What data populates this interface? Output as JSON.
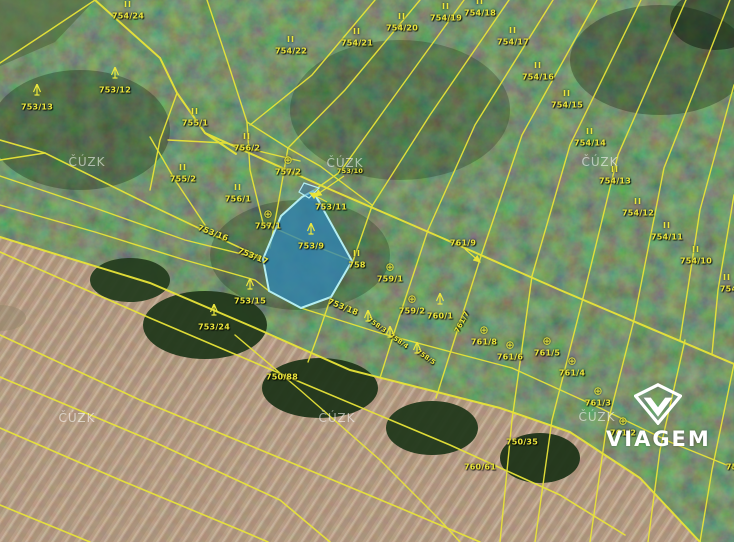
{
  "map": {
    "provider_watermark": "ČÚZK",
    "watermark_positions": [
      {
        "x": 87,
        "y": 162
      },
      {
        "x": 345,
        "y": 163
      },
      {
        "x": 600,
        "y": 162
      },
      {
        "x": 77,
        "y": 418
      },
      {
        "x": 337,
        "y": 418
      },
      {
        "x": 597,
        "y": 417
      }
    ],
    "highlight": {
      "parcel_number": "753/9",
      "fill": "#2f85b5",
      "border": "#b4eef2"
    },
    "colors": {
      "parcel_line": "#e8e438",
      "label": "#ece73d",
      "forest": "#2a4527",
      "field": "#b29478"
    },
    "labels": [
      {
        "text": "754/24",
        "x": 128,
        "y": 16,
        "sym": "forest"
      },
      {
        "text": "753/12",
        "x": 115,
        "y": 90,
        "sym": "conifer"
      },
      {
        "text": "753/13",
        "x": 37,
        "y": 107,
        "sym": "conifer"
      },
      {
        "text": "754/22",
        "x": 291,
        "y": 51,
        "sym": "forest"
      },
      {
        "text": "754/21",
        "x": 357,
        "y": 43,
        "sym": "forest"
      },
      {
        "text": "754/20",
        "x": 402,
        "y": 28,
        "sym": "forest"
      },
      {
        "text": "754/19",
        "x": 446,
        "y": 18,
        "sym": "forest"
      },
      {
        "text": "754/18",
        "x": 480,
        "y": 13,
        "sym": "forest"
      },
      {
        "text": "754/17",
        "x": 513,
        "y": 42,
        "sym": "forest"
      },
      {
        "text": "754/16",
        "x": 538,
        "y": 77,
        "sym": "forest"
      },
      {
        "text": "754/15",
        "x": 567,
        "y": 105,
        "sym": "forest"
      },
      {
        "text": "754/14",
        "x": 590,
        "y": 143,
        "sym": "forest"
      },
      {
        "text": "754/13",
        "x": 615,
        "y": 181,
        "sym": "forest"
      },
      {
        "text": "754/12",
        "x": 638,
        "y": 213,
        "sym": "forest"
      },
      {
        "text": "754/11",
        "x": 667,
        "y": 237,
        "sym": "forest"
      },
      {
        "text": "754/10",
        "x": 696,
        "y": 261,
        "sym": "forest"
      },
      {
        "text": "754/9",
        "x": 733,
        "y": 289,
        "sym": "forest",
        "symdx": -6
      },
      {
        "text": "755/1",
        "x": 195,
        "y": 123,
        "sym": "forest"
      },
      {
        "text": "756/2",
        "x": 247,
        "y": 148,
        "sym": "forest"
      },
      {
        "text": "755/2",
        "x": 183,
        "y": 179,
        "sym": "forest"
      },
      {
        "text": "756/1",
        "x": 238,
        "y": 199,
        "sym": "forest"
      },
      {
        "text": "757/2",
        "x": 288,
        "y": 172,
        "sym": "orchard"
      },
      {
        "text": "757/1",
        "x": 268,
        "y": 226,
        "sym": "orchard"
      },
      {
        "text": "753/10",
        "x": 350,
        "y": 171,
        "size": 6.5
      },
      {
        "text": "753/11",
        "x": 331,
        "y": 207
      },
      {
        "text": "753/9",
        "x": 311,
        "y": 246,
        "sym": "conifer"
      },
      {
        "text": "758",
        "x": 357,
        "y": 265,
        "sym": "forest"
      },
      {
        "text": "753/16",
        "x": 213,
        "y": 233,
        "rot": 21
      },
      {
        "text": "753/17",
        "x": 253,
        "y": 256,
        "rot": 22
      },
      {
        "text": "753/18",
        "x": 343,
        "y": 307,
        "rot": 22
      },
      {
        "text": "753/15",
        "x": 250,
        "y": 301,
        "sym": "conifer"
      },
      {
        "text": "753/24",
        "x": 214,
        "y": 327,
        "sym": "conifer"
      },
      {
        "text": "759/1",
        "x": 390,
        "y": 279,
        "sym": "orchard"
      },
      {
        "text": "759/2",
        "x": 412,
        "y": 311,
        "sym": "orchard"
      },
      {
        "text": "760/1",
        "x": 440,
        "y": 316,
        "sym": "conifer"
      },
      {
        "text": "761/9",
        "x": 463,
        "y": 243
      },
      {
        "text": "758/3",
        "x": 377,
        "y": 325,
        "rot": 35,
        "size": 6.5,
        "sym": "conifer",
        "symdx": -9,
        "symdy": -7
      },
      {
        "text": "758/4",
        "x": 399,
        "y": 341,
        "rot": 35,
        "size": 6.5,
        "sym": "conifer",
        "symdx": -9,
        "symdy": -7
      },
      {
        "text": "758/5",
        "x": 426,
        "y": 357,
        "rot": 35,
        "size": 6.5,
        "sym": "conifer",
        "symdx": -9,
        "symdy": -7
      },
      {
        "text": "761/7",
        "x": 462,
        "y": 322,
        "rot": -62,
        "size": 7
      },
      {
        "text": "761/8",
        "x": 484,
        "y": 342,
        "sym": "orchard"
      },
      {
        "text": "761/6",
        "x": 510,
        "y": 357,
        "sym": "orchard"
      },
      {
        "text": "761/5",
        "x": 547,
        "y": 353,
        "sym": "orchard"
      },
      {
        "text": "761/4",
        "x": 572,
        "y": 373,
        "sym": "orchard"
      },
      {
        "text": "761/3",
        "x": 598,
        "y": 403,
        "sym": "orchard"
      },
      {
        "text": "761/2",
        "x": 623,
        "y": 433,
        "sym": "orchard"
      },
      {
        "text": "750/35",
        "x": 522,
        "y": 442
      },
      {
        "text": "750/88",
        "x": 282,
        "y": 377
      },
      {
        "text": "760/61",
        "x": 480,
        "y": 467
      },
      {
        "text": "753/2",
        "x": 739,
        "y": 467
      }
    ],
    "logo": {
      "brand": "VIAGEM"
    }
  }
}
